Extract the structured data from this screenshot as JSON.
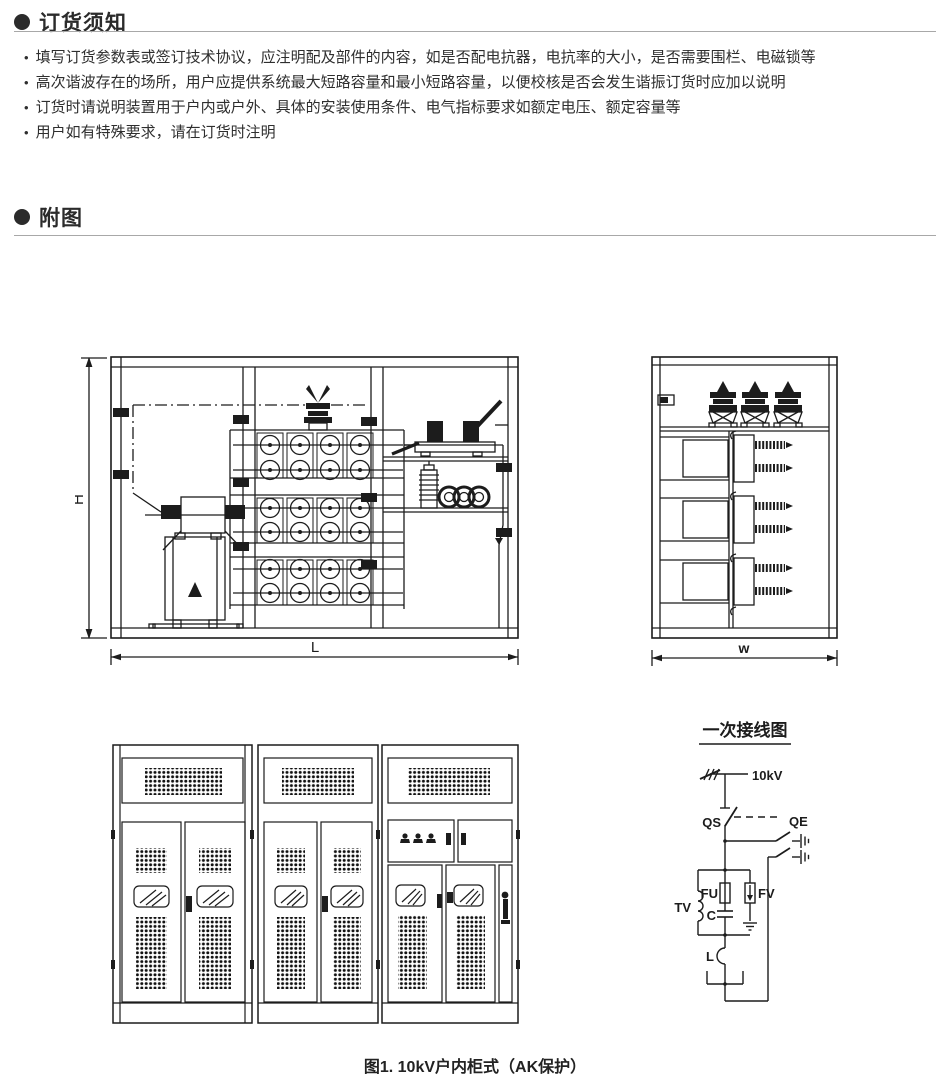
{
  "page": {
    "caption": "图1. 10kV户内柜式（AK保护）"
  },
  "sections": {
    "ordering_notice": {
      "title": "订货须知",
      "bullet_marker": "•",
      "bullets": [
        "填写订货参数表或签订技术协议，应注明配及部件的内容，如是否配电抗器，电抗率的大小，是否需要围栏、电磁锁等",
        "高次谐波存在的场所，用户应提供系统最大短路容量和最小短路容量，以便校核是否会发生谐振订货时应加以说明",
        "订货时请说明装置用于户内或户外、具体的安装使用条件、电气指标要求如额定电压、额定容量等",
        "用户如有特殊要求，请在订货时注明"
      ]
    },
    "attached_figures": {
      "title": "附图"
    }
  },
  "drawings": {
    "front_internal_view": {
      "height_dim_label": "H",
      "length_dim_label": "L"
    },
    "side_view": {
      "width_dim_label": "w"
    },
    "wiring_diagram": {
      "title": "一次接线图",
      "labels": {
        "incoming_voltage": "10kV",
        "disconnector": "QS",
        "earthing_switch": "QE",
        "voltage_transformer": "TV",
        "fuse": "FU",
        "capacitor": "C",
        "surge_arrester": "FV",
        "reactor": "L"
      }
    }
  },
  "colors": {
    "heading_text": "#2b2b2b",
    "body_text": "#2e2e2e",
    "line_art": "#1c1c1c",
    "rule": "#a8a8a8"
  }
}
